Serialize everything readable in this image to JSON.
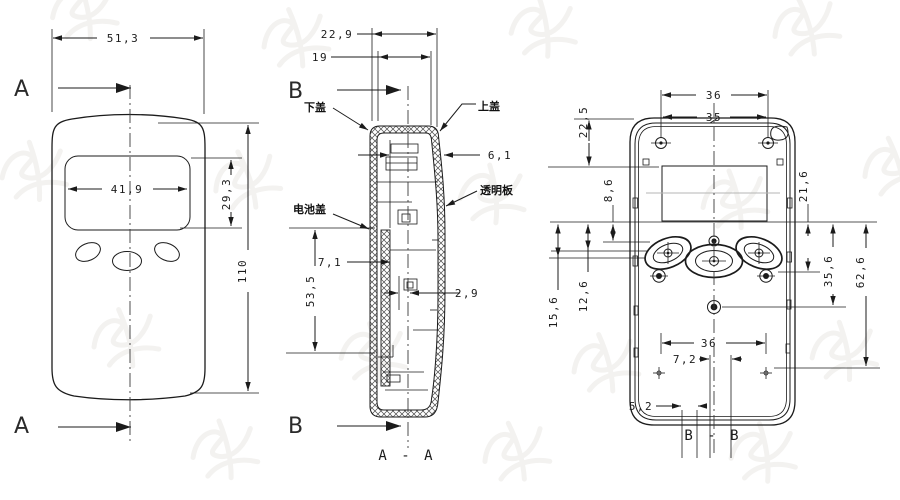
{
  "front": {
    "view_label_top": "A",
    "view_label_bottom": "A",
    "dim_width": "51,3",
    "dim_screen_width": "41,9",
    "dim_screen_height": "29,3",
    "dim_height": "110"
  },
  "section_aa": {
    "view_label_top": "B",
    "view_label_bottom": "B",
    "title": "A - A",
    "dim_depth": "22,9",
    "dim_inner_depth": "19",
    "dim_top": "6,1",
    "dim_gap": "2,9",
    "dim_battery": "7,1",
    "dim_battery_len": "53,5",
    "label_lower_cover": "下盖",
    "label_upper_cover": "上盖",
    "label_transparent_plate": "透明板",
    "label_battery_cover": "电池盖"
  },
  "section_bb": {
    "title": "B - B",
    "dim_boss_span": "36",
    "dim_lcd_width": "35",
    "dim_top_offset": "22,5",
    "dim_lcd_to_buttons": "8,6",
    "dim_screw_offset": "21,6",
    "dim_btn_center": "15,6",
    "dim_btn_top": "12,6",
    "dim_mid_screw": "35,6",
    "dim_bottom": "62,6",
    "dim_slot_span": "36",
    "dim_slot": "7,2",
    "dim_notch": "5,2"
  },
  "colors": {
    "line": "#1b1b1b",
    "watermark": "#e9e7e4"
  }
}
